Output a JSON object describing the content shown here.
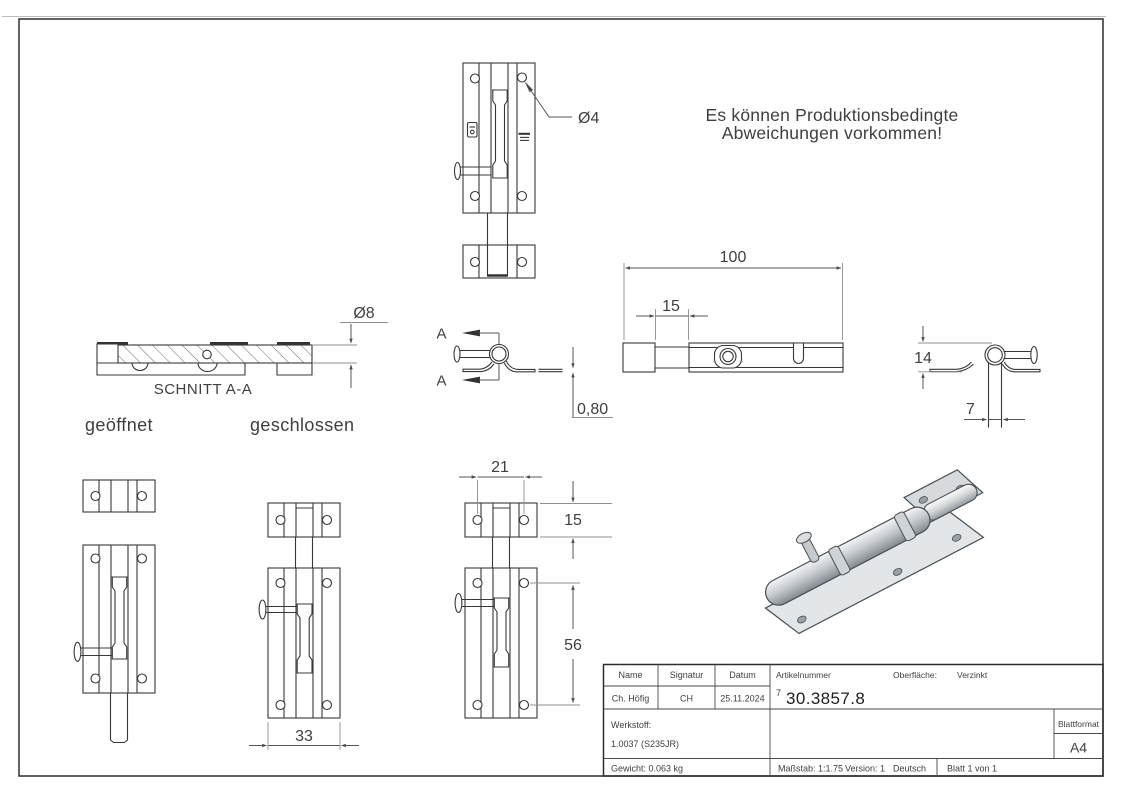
{
  "note": {
    "line1": "Es können Produktionsbedingte",
    "line2": "Abweichungen vorkommen!"
  },
  "labels": {
    "section": "SCHNITT A-A",
    "open": "geöffnet",
    "closed": "geschlossen",
    "cut_arrow": "A"
  },
  "dims": {
    "dia4": "Ø4",
    "dia8": "Ø8",
    "thickness": "0,80",
    "length_total": "100",
    "neck_offset": "15",
    "body_height": "14",
    "rod_width": "7",
    "plate_width": "33",
    "hole_spacing_x": "21",
    "keeper_height": "15",
    "hole_spacing_y": "56"
  },
  "title_block": {
    "name_header": "Name",
    "signatur_header": "Signatur",
    "datum_header": "Datum",
    "name": "Ch. Höfig",
    "signatur": "CH",
    "datum": "25.11.2024",
    "artikelnummer_label": "Artikelnummer",
    "artikelnummer_prefix": "7",
    "artikelnummer": "30.3857.8",
    "oberflaeche_label": "Oberfläche:",
    "oberflaeche_value": "Verzinkt",
    "werkstoff_label": "Werkstoff:",
    "werkstoff_value": "1.0037 (S235JR)",
    "gewicht": "Gewicht: 0.063 kg",
    "massstab": "Maßstab: 1:1.75",
    "version": "Version: 1",
    "sprache": "Deutsch",
    "blatt": "Blatt 1 von 1",
    "blattformat_label": "Blattformat",
    "blattformat_value": "A4"
  },
  "colors": {
    "line": "#383838",
    "dimension": "#575757",
    "background": "#ffffff",
    "render_gray": "#c9cdd1"
  }
}
